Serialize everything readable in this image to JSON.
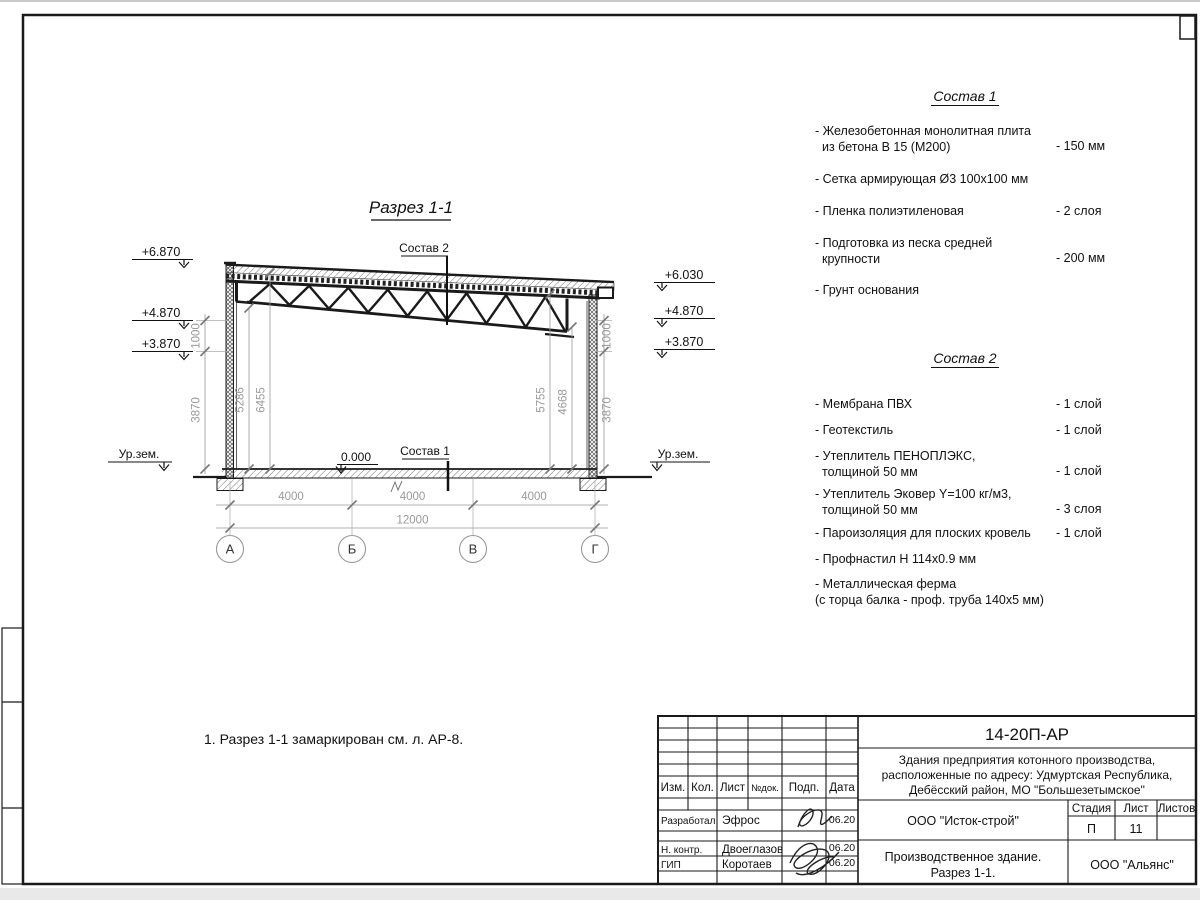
{
  "page": {
    "note": "1. Разрез 1-1 замаркирован см. л. АР-8."
  },
  "section": {
    "title": "Разрез 1-1",
    "label_sostav2": "Состав 2",
    "label_sostav1": "Состав 1",
    "label_zero": "0.000",
    "label_ground_left": "Ур.зем.",
    "label_ground_right": "Ур.зем.",
    "elev_left": [
      "+6.870",
      "+4.870",
      "+3.870"
    ],
    "elev_right": [
      "+6.030",
      "+4.870",
      "+3.870"
    ],
    "dims_left_outer": [
      "1000",
      "3870"
    ],
    "dims_left_inner": [
      "5286",
      "6455"
    ],
    "dims_right_inner": [
      "5755",
      "4668"
    ],
    "dims_right_outer": [
      "1000",
      "3870"
    ],
    "dims_bottom": [
      "4000",
      "4000",
      "4000"
    ],
    "dim_total": "12000",
    "axes": [
      "А",
      "Б",
      "В",
      "Г"
    ]
  },
  "sostav1": {
    "title": "Состав 1",
    "items": [
      {
        "lines": [
          "- Железобетонная  монолитная плита",
          "из бетона В 15 (М200)"
        ],
        "value": "- 150 мм"
      },
      {
        "lines": [
          "- Сетка армирующая Ø3 100х100 мм"
        ],
        "value": ""
      },
      {
        "lines": [
          "- Пленка полиэтиленовая"
        ],
        "value": "-  2 слоя"
      },
      {
        "lines": [
          "- Подготовка из песка средней",
          "крупности"
        ],
        "value": "- 200 мм"
      },
      {
        "lines": [
          "- Грунт основания"
        ],
        "value": ""
      }
    ]
  },
  "sostav2": {
    "title": "Состав 2",
    "items": [
      {
        "lines": [
          "- Мембрана ПВХ"
        ],
        "value": "- 1 слой"
      },
      {
        "lines": [
          "- Геотекстиль"
        ],
        "value": "- 1 слой"
      },
      {
        "lines": [
          "- Утеплитель ПЕНОПЛЭКС,",
          "толщиной 50 мм"
        ],
        "value": "- 1 слой"
      },
      {
        "lines": [
          "- Утеплитель Эковер Y=100 кг/м3,",
          "толщиной 50 мм"
        ],
        "value": "- 3 слоя"
      },
      {
        "lines": [
          "- Пароизоляция для плоских кровель"
        ],
        "value": "- 1 слой"
      },
      {
        "lines": [
          "- Профнастил Н 114х0.9 мм"
        ],
        "value": ""
      },
      {
        "lines": [
          "- Металлическая ферма",
          "(с торца балка - проф. труба 140х5 мм)"
        ],
        "value": ""
      }
    ]
  },
  "titleblock": {
    "doc_number": "14-20П-АР",
    "desc_lines": [
      "Здания предприятия котонного производства,",
      "расположенные по адресу: Удмуртская Республика,",
      "Дебёсский район, МО \"Большезетымское\""
    ],
    "header": {
      "izm": "Изм.",
      "kol": "Кол.",
      "list": "Лист",
      "ndok": "№док.",
      "podp": "Подп.",
      "data": "Дата"
    },
    "rows": [
      {
        "role": "Разработал",
        "name": "Эфрос",
        "date": "06.20"
      },
      {
        "role": "Н. контр.",
        "name": "Двоеглазов",
        "date": "06.20"
      },
      {
        "role": "ГИП",
        "name": "Коротаев",
        "date": "06.20"
      }
    ],
    "org": "ООО \"Исток-строй\"",
    "stage_label": "Стадия",
    "sheet_label": "Лист",
    "sheets_label": "Листов",
    "stage": "П",
    "sheet": "11",
    "object_lines": [
      "Производственное здание.",
      "Разрез 1-1."
    ],
    "contractor": "ООО \"Альянс\""
  }
}
